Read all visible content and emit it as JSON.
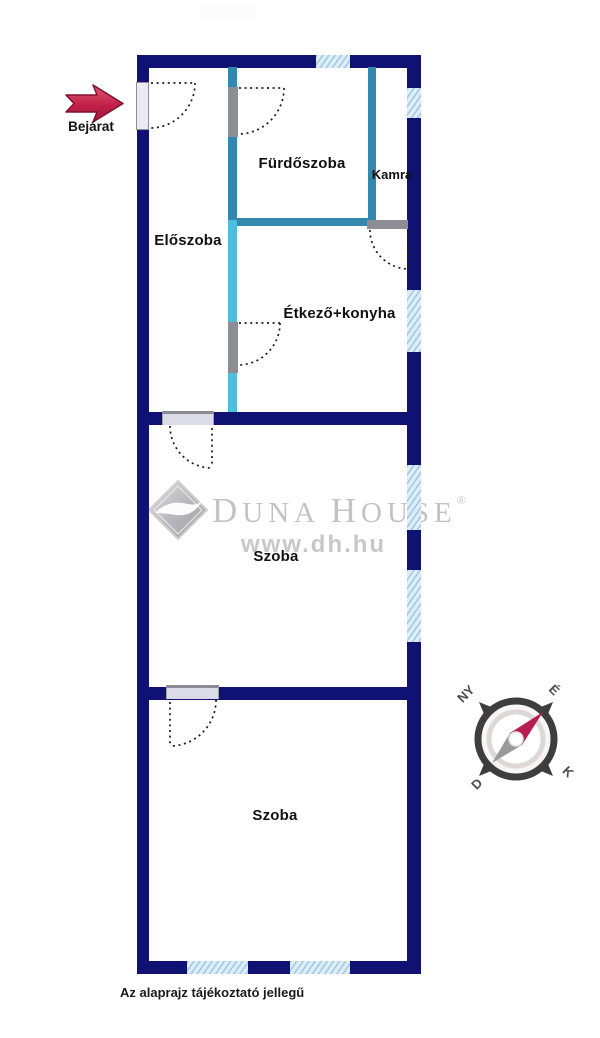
{
  "entrance": {
    "label": "Bejárat"
  },
  "rooms": [
    {
      "label": "Előszoba"
    },
    {
      "label": "Fürdőszoba"
    },
    {
      "label": "Kamra"
    },
    {
      "label": "Étkező+konyha"
    },
    {
      "label": "Szoba"
    },
    {
      "label": "Szoba"
    }
  ],
  "note": "Az alaprajz tájékoztató jellegű",
  "watermark": {
    "d1": "D",
    "rest1": "UNA ",
    "d2": "H",
    "rest2": "OUSE",
    "reg": "®",
    "url": "www.dh.hu"
  },
  "compass": {
    "nw": "NY",
    "ne": "É",
    "sw": "D",
    "se": "K"
  },
  "colors": {
    "wall_navy": "#101273",
    "wall_teal": "#3389ad",
    "wall_teal_light": "#4fbedd",
    "window_blue": "#cfe4f2",
    "door_gray": "#8d8d95",
    "arrow_red": "#c22048",
    "needle_red": "#b81d4f",
    "watermark_gray": "#c3c3c3",
    "label_black": "#111111"
  }
}
